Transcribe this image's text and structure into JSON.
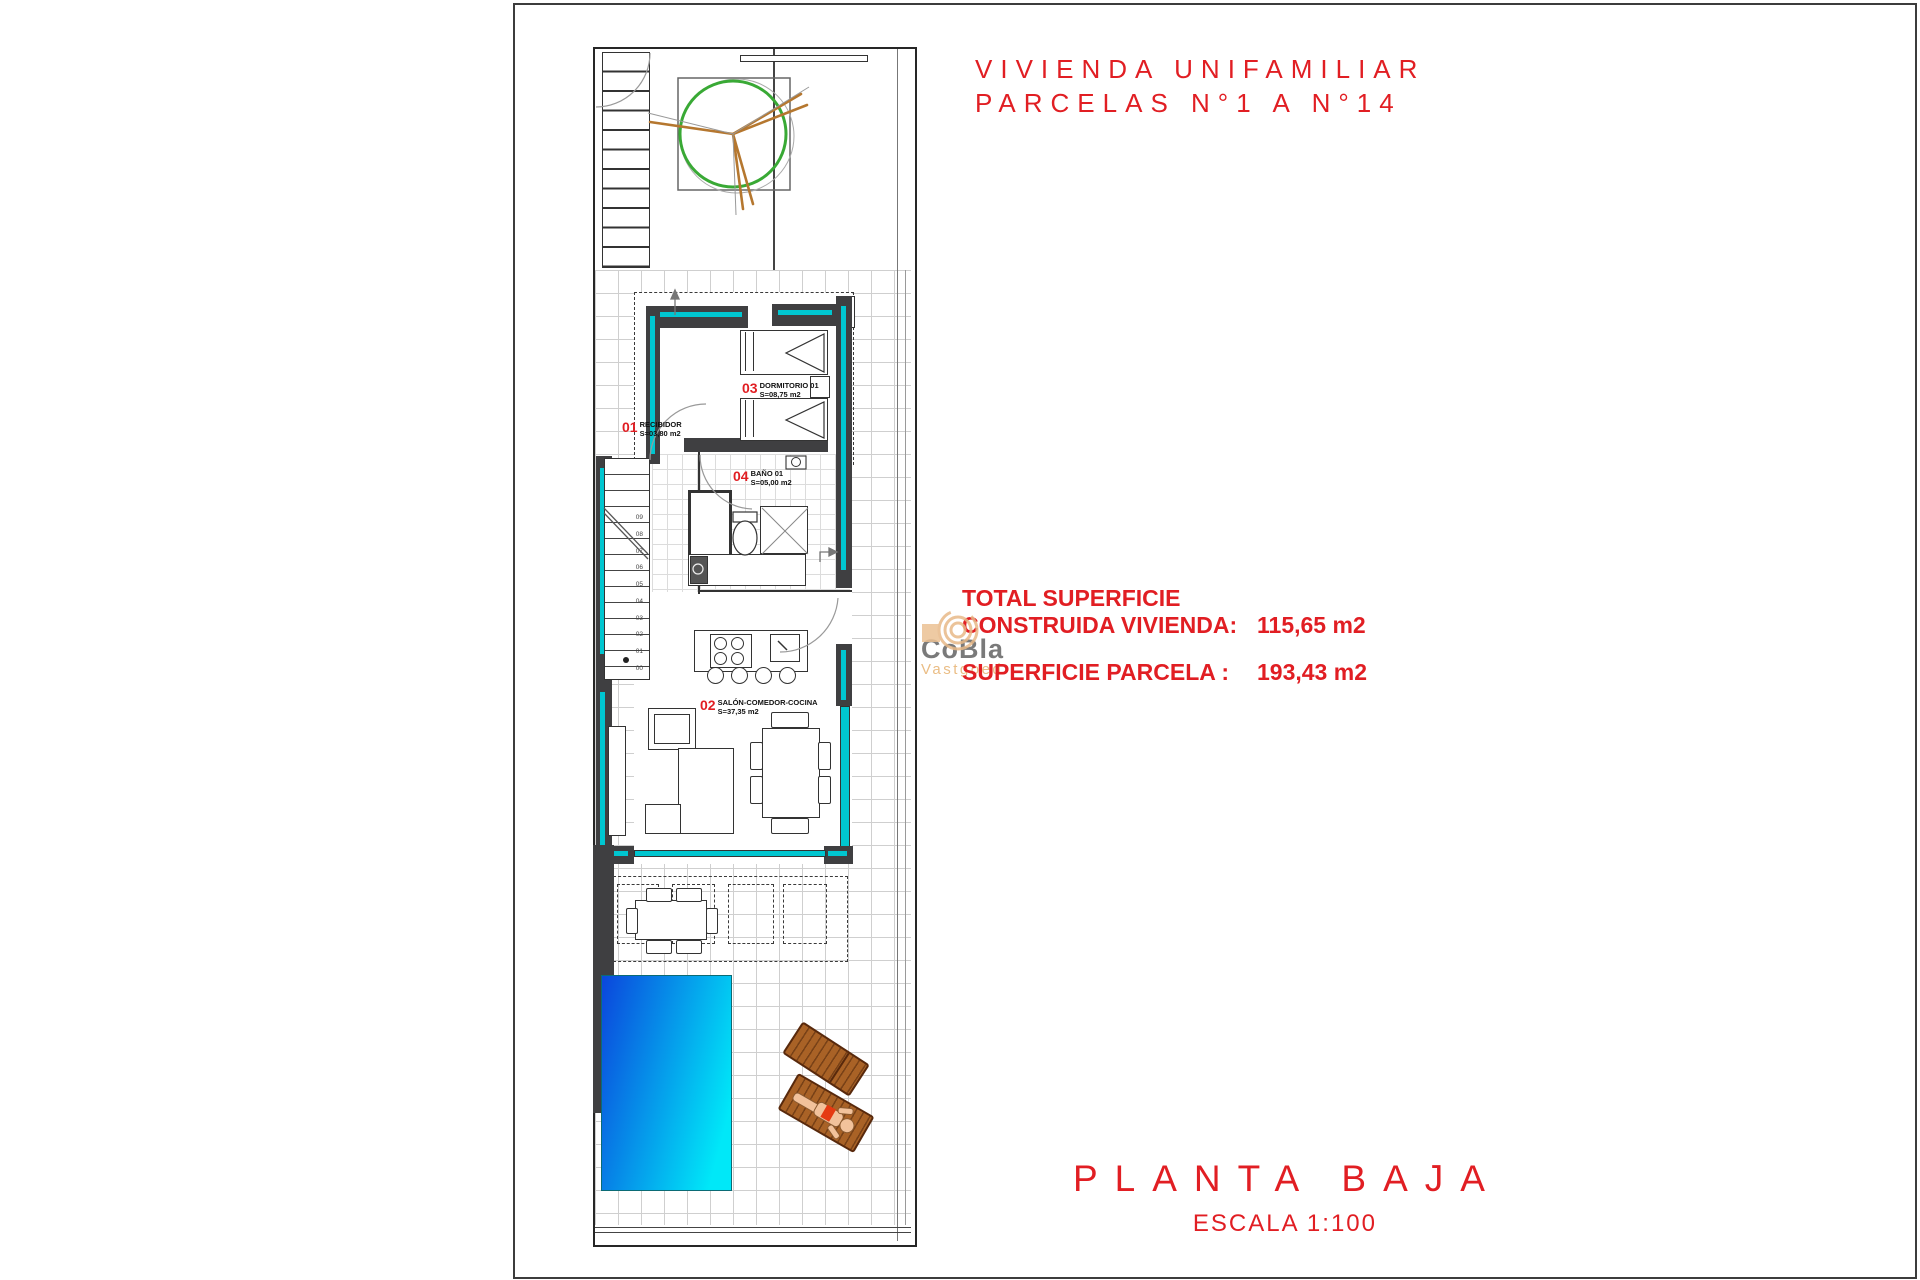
{
  "colors": {
    "red": "#e11e23",
    "cyan": "#00c6d0",
    "wall": "#3f3f41",
    "pool_blue": "#0b46dc",
    "pool_cyan": "#00e8f8",
    "tree_green": "#39a935",
    "branch_brown": "#b5772f",
    "wood_brown": "#a96226",
    "watermark_gray": "#7a7a7a",
    "watermark_tan": "#eabd85",
    "grid_line": "#cfcfcf"
  },
  "title": {
    "line1": "VIVIENDA UNIFAMILIAR",
    "line2": "PARCELAS N°1 A N°14"
  },
  "summary": {
    "heading": "TOTAL SUPERFICIE",
    "rows": [
      {
        "label": "CONSTRUIDA VIVIENDA:",
        "value": "115,65 m2"
      },
      {
        "label": "SUPERFICIE PARCELA :",
        "value": "193,43 m2"
      }
    ]
  },
  "watermark": {
    "name": "CoBla",
    "subtitle": "Vastgoed"
  },
  "rooms": [
    {
      "number": "01",
      "name": "RECIBIDOR",
      "area": "S=03,80 m2"
    },
    {
      "number": "02",
      "name": "SALÓN-COMEDOR-COCINA",
      "area": "S=37,35 m2"
    },
    {
      "number": "03",
      "name": "DORMITORIO 01",
      "area": "S=08,75 m2"
    },
    {
      "number": "04",
      "name": "BAÑO 01",
      "area": "S=05,00 m2"
    }
  ],
  "stairs": {
    "steps": [
      "00",
      "01",
      "02",
      "03",
      "04",
      "05",
      "06",
      "07",
      "08",
      "09"
    ]
  },
  "footer": {
    "plan_name": "PLANTA BAJA",
    "scale": "ESCALA 1:100"
  }
}
